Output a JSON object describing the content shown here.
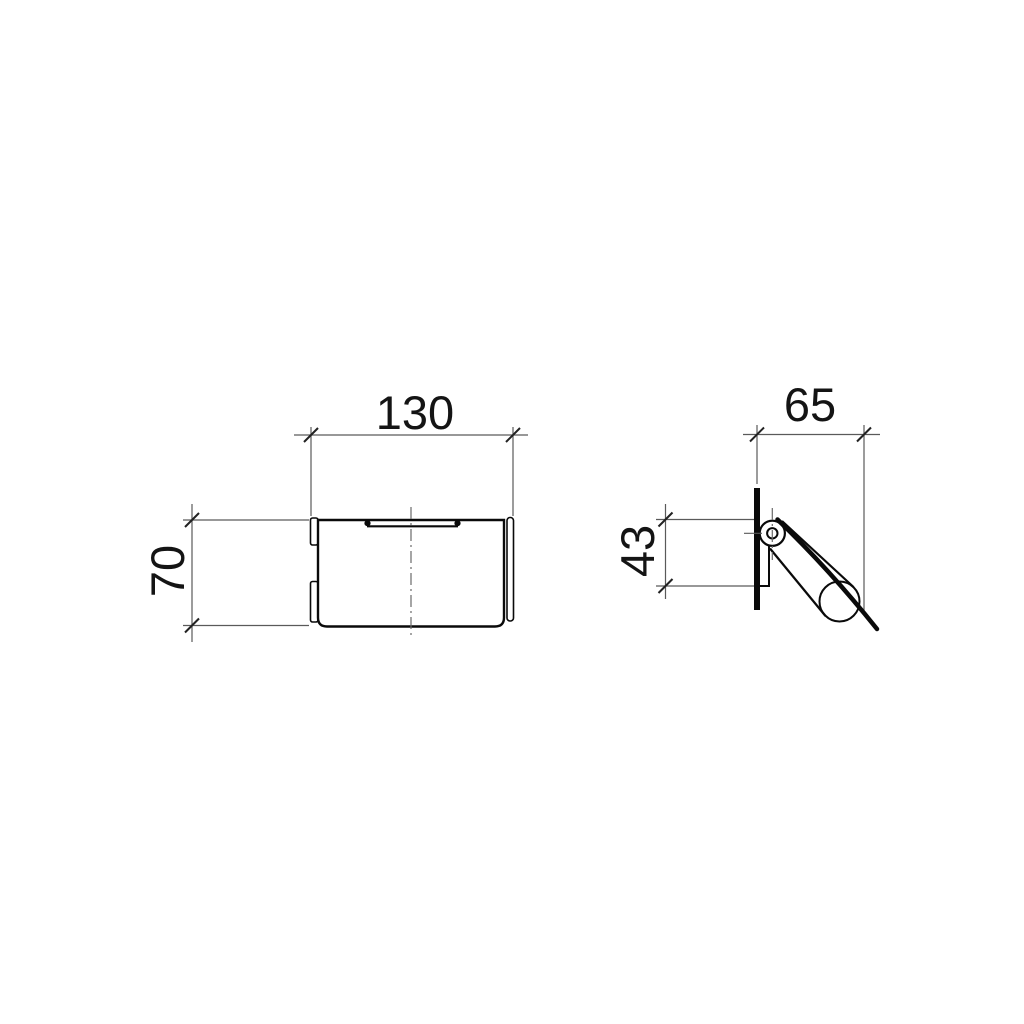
{
  "drawing": {
    "type": "technical-dimension-drawing",
    "subject": "wall-mounted covered roll holder, two orthographic views",
    "front_view": {
      "width_label": "130",
      "height_label": "70"
    },
    "side_view": {
      "depth_label": "65",
      "pivot_height_label": "43"
    },
    "colors": {
      "background": "#ffffff",
      "part_line": "#0a0a0a",
      "thin_line": "#5a5a5a",
      "text": "#141414"
    }
  }
}
